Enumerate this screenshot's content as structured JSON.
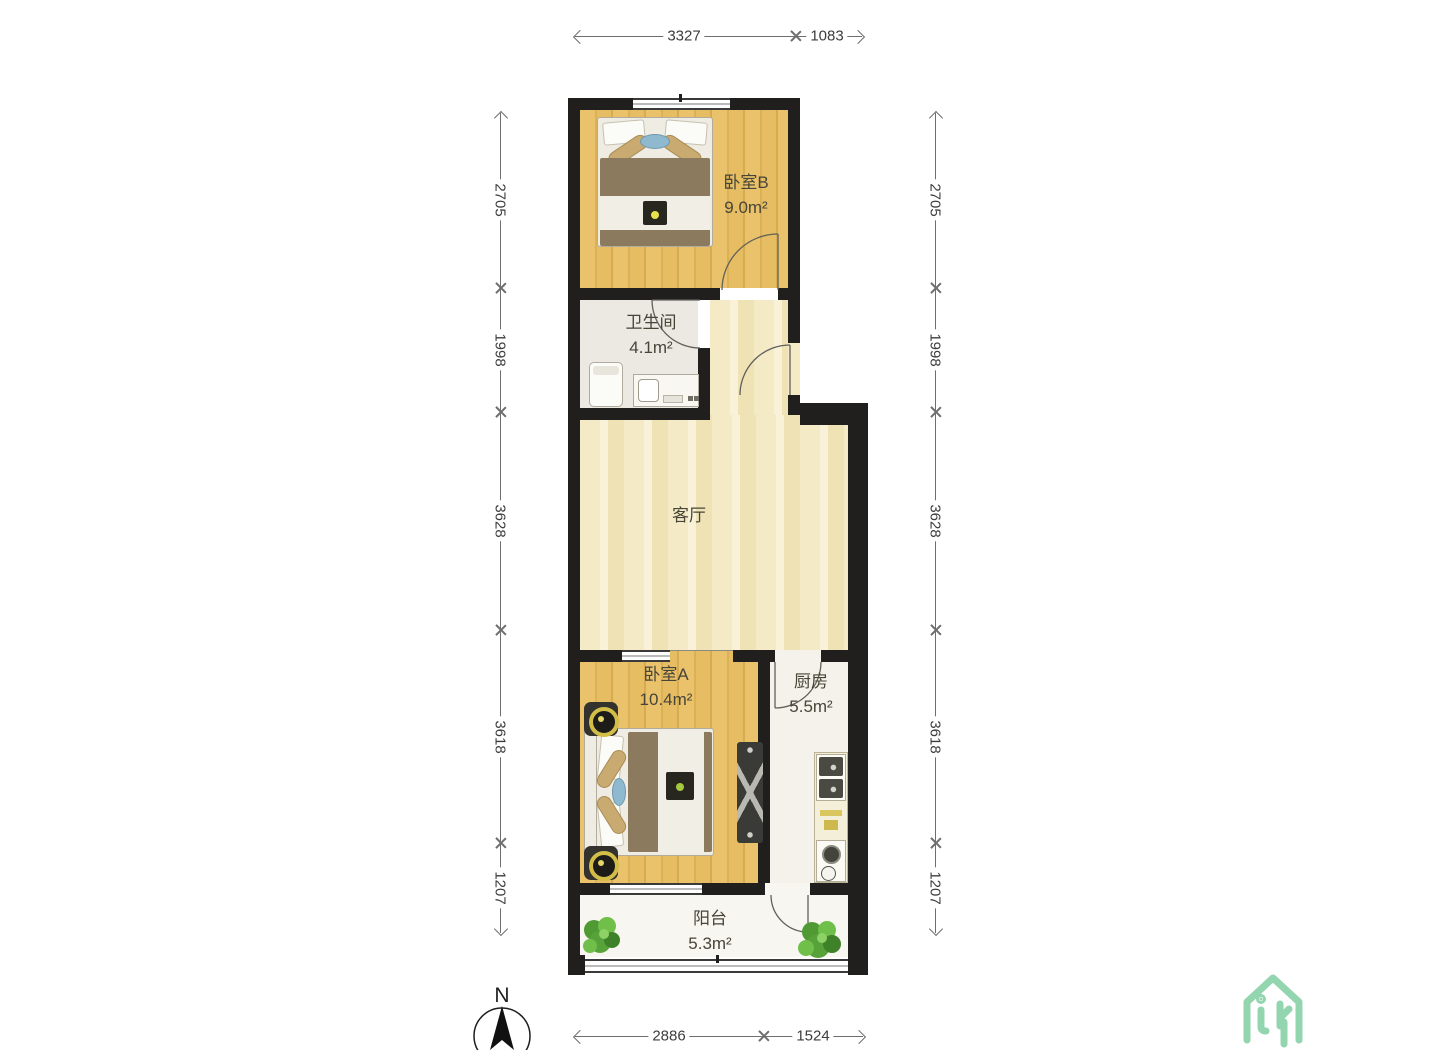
{
  "rooms": {
    "bedroom_b": {
      "name": "卧室B",
      "area": "9.0m²"
    },
    "bathroom": {
      "name": "卫生间",
      "area": "4.1m²"
    },
    "living": {
      "name": "客厅"
    },
    "bedroom_a": {
      "name": "卧室A",
      "area": "10.4m²"
    },
    "kitchen": {
      "name": "厨房",
      "area": "5.5m²"
    },
    "balcony": {
      "name": "阳台",
      "area": "5.3m²"
    }
  },
  "dimensions_mm": {
    "top": [
      "3327",
      "1083"
    ],
    "bottom": [
      "2886",
      "1524"
    ],
    "left": [
      "2705",
      "1998",
      "3628",
      "3618",
      "1207"
    ],
    "right": [
      "2705",
      "1998",
      "3628",
      "3618",
      "1207"
    ]
  },
  "compass": {
    "label": "N"
  },
  "colors": {
    "wall": "#201f1d",
    "wood_floor": "#eac26b",
    "living_floor": "#f4ebc6",
    "dimension_line": "#6e6e6e",
    "logo_green": "#93d5af",
    "plant_green": "#57a33a"
  }
}
